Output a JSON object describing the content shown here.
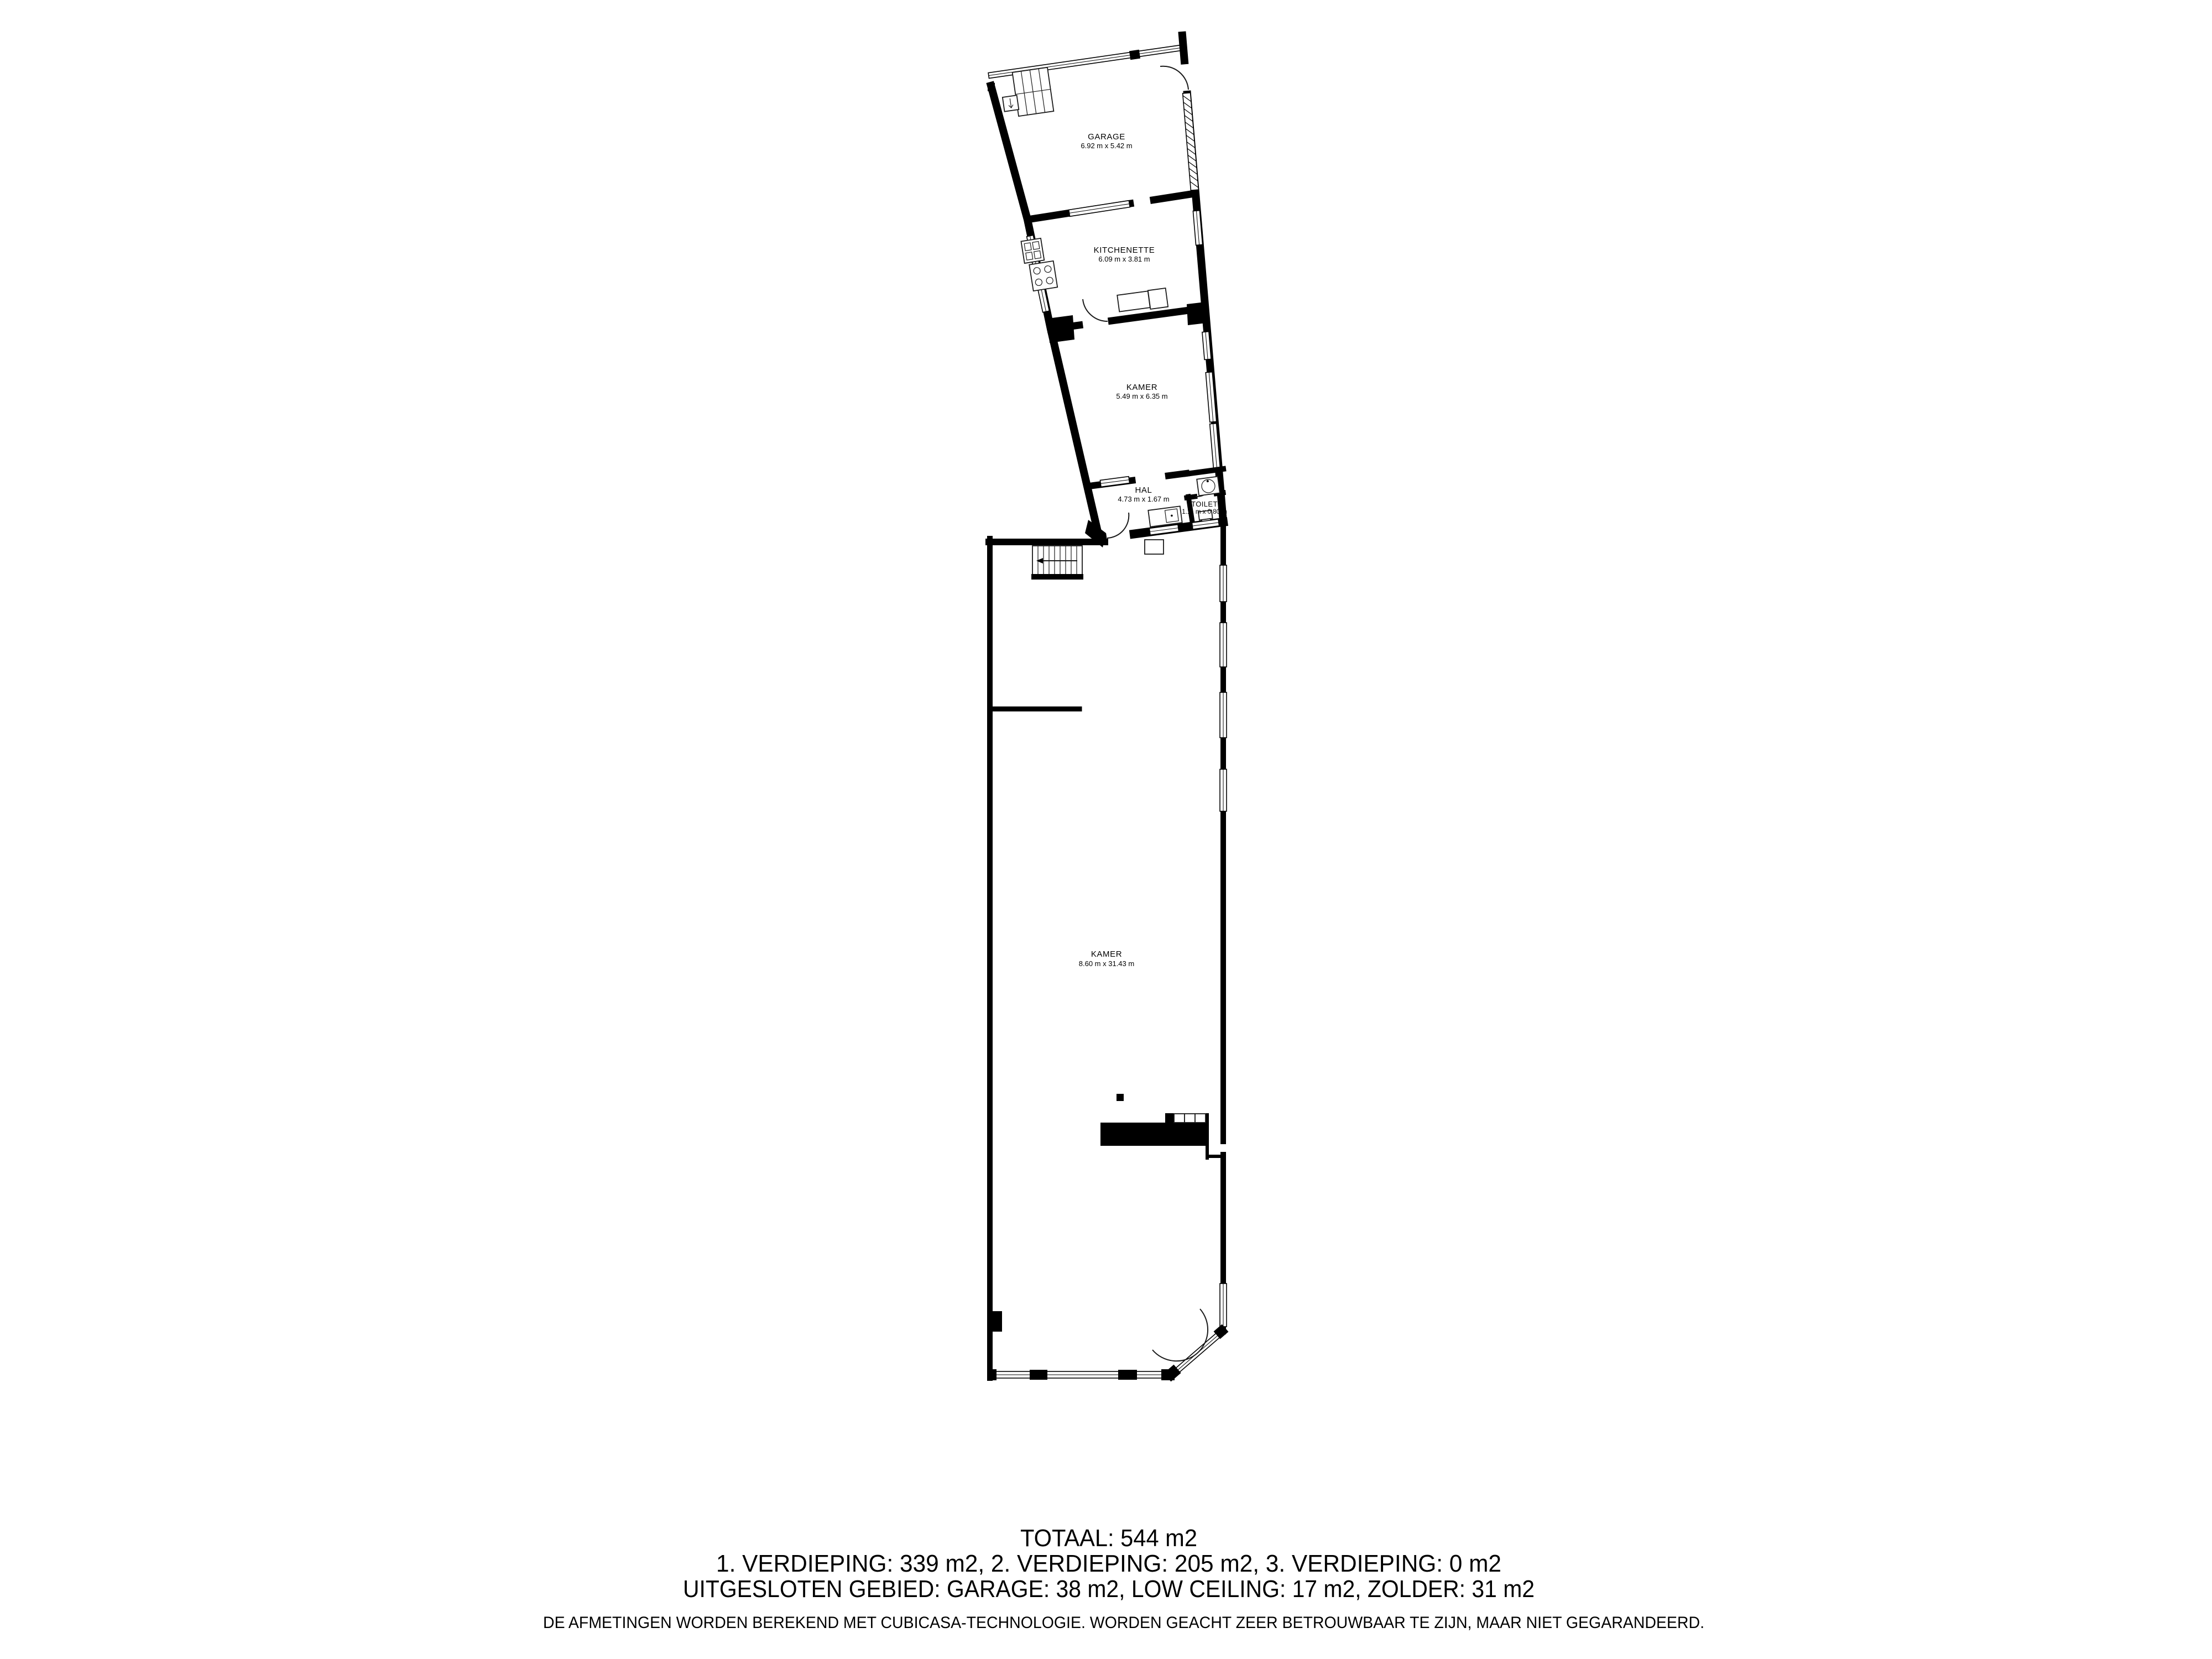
{
  "document": {
    "type": "floor-plan",
    "background_color": "#ffffff",
    "wall_color": "#000000",
    "text_color": "#000000"
  },
  "floor_plan": {
    "rooms": [
      {
        "id": "garage",
        "name": "GARAGE",
        "dims": "6.92 m x 5.42 m"
      },
      {
        "id": "kitchenette",
        "name": "KITCHENETTE",
        "dims": "6.09 m x 3.81 m"
      },
      {
        "id": "kamer_upper",
        "name": "KAMER",
        "dims": "5.49 m x 6.35 m"
      },
      {
        "id": "hal",
        "name": "HAL",
        "dims": "4.73 m x 1.67 m"
      },
      {
        "id": "toilet",
        "name": "TOILET",
        "dims": "1.11 m x 0.80 m"
      },
      {
        "id": "kamer_lower",
        "name": "KAMER",
        "dims": "8.60 m x 31.43 m"
      }
    ],
    "icons": [
      "stairs-up-arrow-icon",
      "door-swing-arc-icon",
      "window-band-icon",
      "garage-door-hatch-icon"
    ]
  },
  "summary": {
    "total": "TOTAAL: 544 m2",
    "floors": "1. VERDIEPING: 339 m2, 2. VERDIEPING: 205 m2, 3. VERDIEPING: 0 m2",
    "excluded": "UITGESLOTEN GEBIED: GARAGE: 38 m2, LOW CEILING: 17 m2, ZOLDER: 31 m2",
    "disclaimer": "DE AFMETINGEN WORDEN BEREKEND MET CUBICASA-TECHNOLOGIE. WORDEN GEACHT ZEER BETROUWBAAR TE ZIJN, MAAR NIET GEGARANDEERD."
  }
}
